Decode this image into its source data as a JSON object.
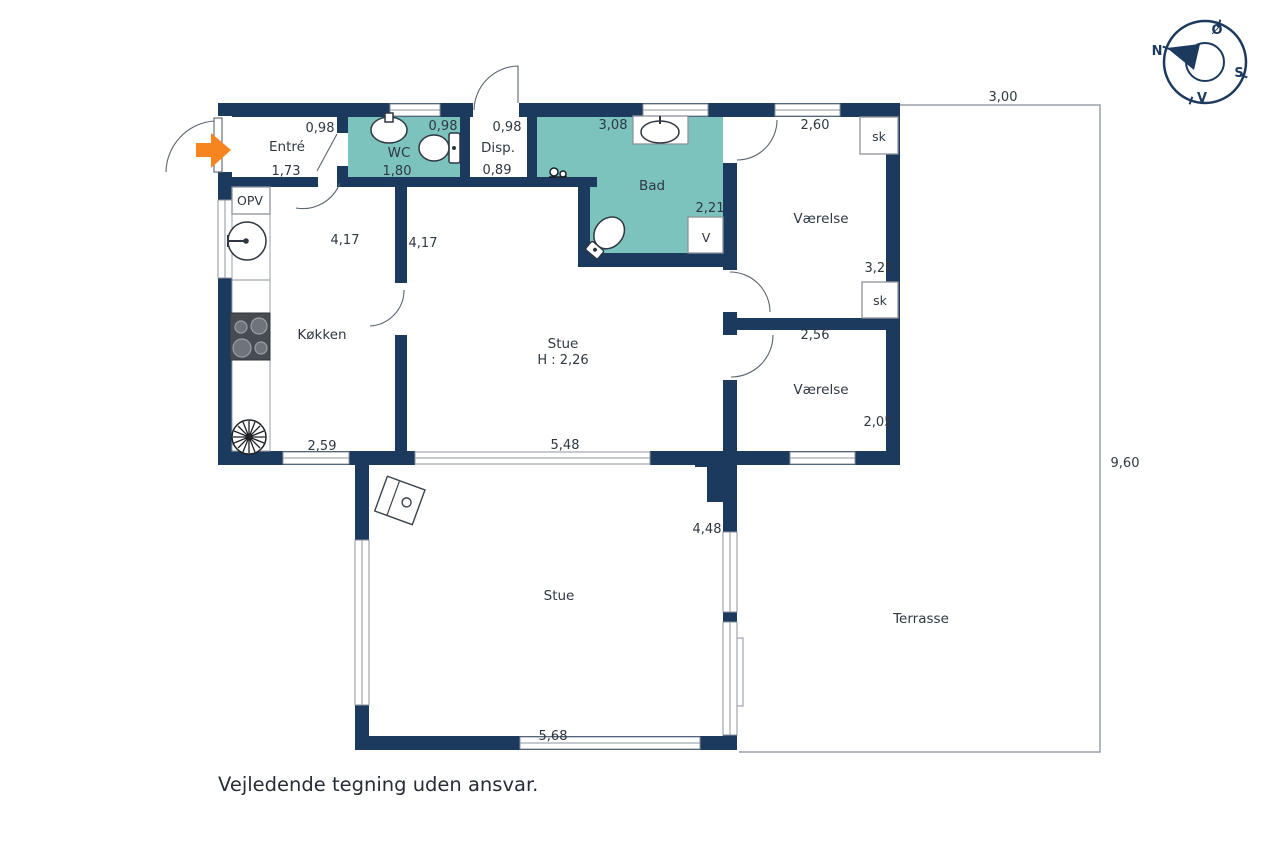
{
  "title": "Floor plan",
  "disclaimer": "Vejledende tegning uden ansvar.",
  "compass": {
    "north": "N",
    "east": "Ø",
    "south": "S",
    "west": "V"
  },
  "colors": {
    "wall_navy": "#1c3a5e",
    "wet_room_teal": "#7cc2bd",
    "entry_arrow_orange": "#f6841f",
    "label_text": "#2e3742",
    "outline_gray": "#8d939b"
  },
  "rooms": {
    "entre": {
      "label": "Entré",
      "dim_top": "0,98",
      "dim_bottom": "1,73"
    },
    "wc": {
      "label": "WC",
      "dim_top": "0,98",
      "dim_bottom": "1,80"
    },
    "disp": {
      "label": "Disp.",
      "dim_top": "0,98",
      "dim_bottom": "0,89"
    },
    "bad": {
      "label": "Bad",
      "dim_top": "3,08",
      "dim_right": "2,21",
      "washer_label": "V"
    },
    "vaerelse1": {
      "label": "Værelse",
      "dim_top": "2,60",
      "dim_bottom": "3,20",
      "closet_label": "sk"
    },
    "vaerelse2": {
      "label": "Værelse",
      "dim_top": "2,56",
      "dim_right": "2,05",
      "closet_label": "sk"
    },
    "koekken": {
      "label": "Køkken",
      "dim_side": "4,17",
      "dim_bottom": "2,59",
      "dishwasher_label": "OPV"
    },
    "stue": {
      "label": "Stue",
      "ceiling_height": "H : 2,26",
      "dim_side": "4,17",
      "dim_bottom": "5,48"
    },
    "stue2": {
      "label": "Stue",
      "dim_side": "4,48",
      "dim_bottom": "5,68"
    },
    "terrasse": {
      "label": "Terrasse",
      "dim_top": "3,00",
      "dim_right": "9,60"
    }
  },
  "icons": {
    "compass": "compass-rose-icon",
    "entry": "entry-arrow-icon",
    "wc_fixtures": [
      "sink-icon",
      "toilet-icon"
    ],
    "bad_fixtures": [
      "sink-icon",
      "toilet-icon",
      "shower-mixer-icon",
      "washing-machine-box"
    ],
    "kitchen_fixtures": [
      "dishwasher-box",
      "kitchen-sink-icon",
      "stove-icon",
      "fan-icon"
    ],
    "stue_fixtures": [
      "wood-stove-icon"
    ]
  }
}
